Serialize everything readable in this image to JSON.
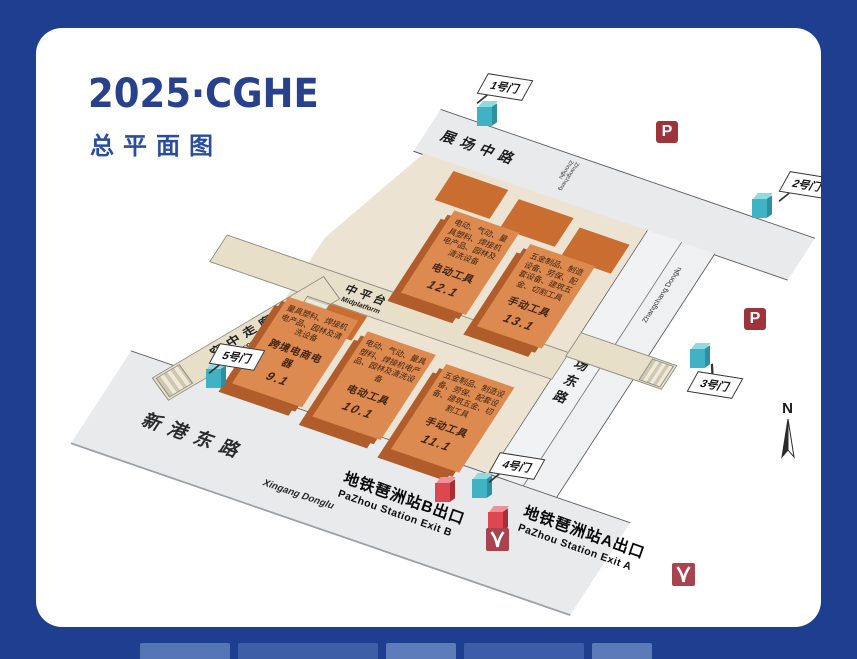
{
  "header": {
    "title": "2025·CGHE",
    "subtitle": "总平面图"
  },
  "map": {
    "roads": {
      "zhanchang_zhong": {
        "zh": "展场中路",
        "en": "Zhangchang Zhonglu"
      },
      "zhanchang_dong": {
        "zh": "展场东路",
        "en": "Zhangchang Donglu"
      },
      "xingang": {
        "zh": "新港东路",
        "en": "Xingang Donglu"
      }
    },
    "structures": {
      "midplatform": {
        "zh": "中平台",
        "en": "Midplatform"
      },
      "air_corridor": {
        "zh": "空中走廊",
        "en": "Air corridor"
      }
    },
    "halls": [
      {
        "id": "9.1",
        "category": "跨境电商电器",
        "desc": "量具塑料、焊接机电产品、园林及清洗设备"
      },
      {
        "id": "10.1",
        "category": "电动工具",
        "desc": "电动、气动、量具塑料、焊接机电产品、园林及清洗设备"
      },
      {
        "id": "11.1",
        "category": "手动工具",
        "desc": "五金制品、制造设备、劳保、配套设备、建筑五金、切割工具"
      },
      {
        "id": "12.1",
        "category": "电动工具",
        "desc": "电动、气动、量具塑料、焊接机电产品、园林及清洗设备"
      },
      {
        "id": "13.1",
        "category": "手动工具",
        "desc": "五金制品、制造设备、劳保、配套设备、建筑五金、切割工具"
      }
    ],
    "gates": [
      {
        "label": "1号门"
      },
      {
        "label": "2号门"
      },
      {
        "label": "3号门"
      },
      {
        "label": "4号门"
      },
      {
        "label": "5号门"
      }
    ],
    "metro": {
      "exit_b": {
        "zh": "地铁琶洲站B出口",
        "en": "PaZhou Station Exit B"
      },
      "exit_a": {
        "zh": "地铁琶洲站A出口",
        "en": "PaZhou Station Exit A"
      }
    },
    "parking_label": "P",
    "compass_label": "N"
  },
  "colors": {
    "frame_blue": "#1e3f8f",
    "title_blue": "#27418c",
    "hall_orange": "#dd8a50",
    "hall_side_orange": "#b05c2b",
    "pad_orange": "#ca6d31",
    "gate_teal": "#41b2c4",
    "metro_cube_red": "#dd4750",
    "parking_red": "#9d343b",
    "metro_logo_red": "#a84350",
    "grounds_beige": "#ece3d2",
    "road_gray": "#e9eaec"
  }
}
